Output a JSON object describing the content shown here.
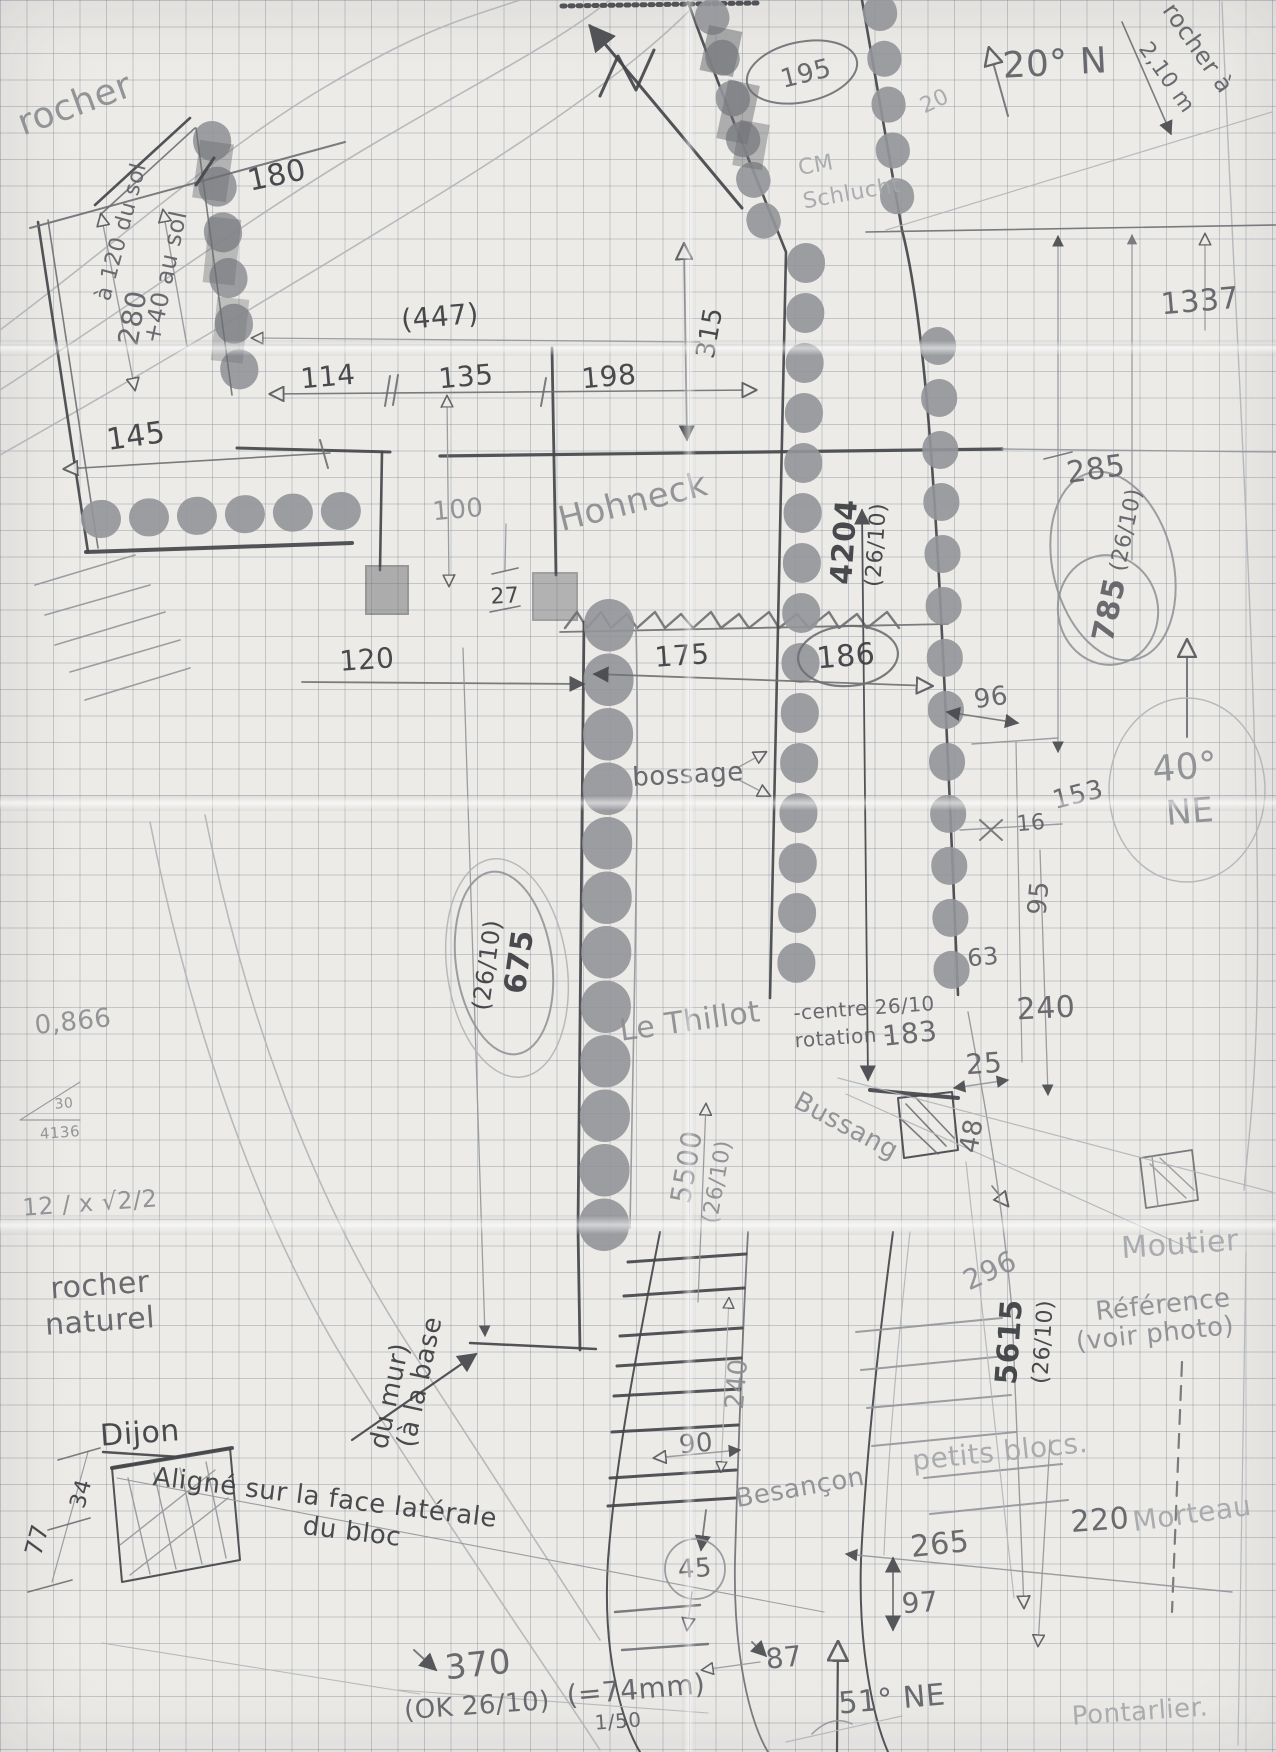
{
  "diagram": {
    "paper": {
      "background": "#ecebe7",
      "grid_color": "rgba(125,135,150,.38)",
      "grid_size_px": 26.5,
      "pencil_dark": "#46474b",
      "pencil_mid": "#6e6f73",
      "pencil_light": "#94959a",
      "pencil_xlight": "#b3b4b8"
    },
    "labels": [
      {
        "id": "rocher-top-left",
        "text": "rocher",
        "x": 75,
        "y": 105,
        "rot": -20,
        "size": 36,
        "tone": "light",
        "bold": false
      },
      {
        "id": "dim-180",
        "text": "180",
        "x": 277,
        "y": 176,
        "rot": -12,
        "size": 30,
        "tone": "dark",
        "bold": false
      },
      {
        "id": "note-a-120-du-sol",
        "text": "à 120 du sol",
        "x": 122,
        "y": 232,
        "rot": -75,
        "size": 22,
        "tone": "mid",
        "bold": false
      },
      {
        "id": "dim-280",
        "text": "280",
        "x": 133,
        "y": 318,
        "rot": -80,
        "size": 28,
        "tone": "mid",
        "bold": false
      },
      {
        "id": "note-plus-40-au-sol",
        "text": "+40 au sol",
        "x": 165,
        "y": 277,
        "rot": -78,
        "size": 24,
        "tone": "mid",
        "bold": false
      },
      {
        "id": "dim-145",
        "text": "145",
        "x": 136,
        "y": 437,
        "rot": -8,
        "size": 30,
        "tone": "dark",
        "bold": false
      },
      {
        "id": "dim-447",
        "text": "(447)",
        "x": 440,
        "y": 317,
        "rot": -5,
        "size": 28,
        "tone": "dark",
        "bold": false
      },
      {
        "id": "dim-114",
        "text": "114",
        "x": 328,
        "y": 377,
        "rot": -5,
        "size": 28,
        "tone": "dark",
        "bold": false
      },
      {
        "id": "dim-135",
        "text": "135",
        "x": 466,
        "y": 377,
        "rot": -5,
        "size": 28,
        "tone": "dark",
        "bold": false
      },
      {
        "id": "dim-198",
        "text": "198",
        "x": 609,
        "y": 377,
        "rot": -5,
        "size": 28,
        "tone": "dark",
        "bold": false
      },
      {
        "id": "dim-315",
        "text": "315",
        "x": 710,
        "y": 333,
        "rot": -80,
        "size": 26,
        "tone": "dark",
        "bold": false
      },
      {
        "id": "dim-195",
        "text": "195",
        "x": 806,
        "y": 74,
        "rot": -14,
        "size": 26,
        "tone": "mid",
        "bold": false
      },
      {
        "id": "note-cm",
        "text": "CM",
        "x": 816,
        "y": 166,
        "rot": -10,
        "size": 22,
        "tone": "xlight",
        "bold": false
      },
      {
        "id": "note-schlucht",
        "text": "Schlucht",
        "x": 852,
        "y": 194,
        "rot": -10,
        "size": 22,
        "tone": "xlight",
        "bold": false
      },
      {
        "id": "dim-20-faint",
        "text": "20",
        "x": 935,
        "y": 102,
        "rot": -25,
        "size": 22,
        "tone": "xlight",
        "bold": false
      },
      {
        "id": "angle-20-n",
        "text": "20° N",
        "x": 1055,
        "y": 64,
        "rot": -3,
        "size": 36,
        "tone": "mid",
        "bold": false
      },
      {
        "id": "note-rocher-a",
        "text": "rocher à",
        "x": 1198,
        "y": 48,
        "rot": 55,
        "size": 24,
        "tone": "mid",
        "bold": false
      },
      {
        "id": "note-2-10-m",
        "text": "2,10 m",
        "x": 1166,
        "y": 78,
        "rot": 55,
        "size": 22,
        "tone": "mid",
        "bold": false
      },
      {
        "id": "dim-1337",
        "text": "1337",
        "x": 1200,
        "y": 302,
        "rot": -5,
        "size": 30,
        "tone": "mid",
        "bold": false
      },
      {
        "id": "dim-100",
        "text": "100",
        "x": 458,
        "y": 510,
        "rot": -5,
        "size": 26,
        "tone": "light",
        "bold": false
      },
      {
        "id": "place-hohneck",
        "text": "Hohneck",
        "x": 633,
        "y": 502,
        "rot": -14,
        "size": 34,
        "tone": "light",
        "bold": false
      },
      {
        "id": "dim-4204",
        "text": "4204",
        "x": 845,
        "y": 542,
        "rot": -86,
        "size": 30,
        "tone": "dark",
        "bold": true
      },
      {
        "id": "dim-4204-date",
        "text": "(26/10)",
        "x": 877,
        "y": 545,
        "rot": -86,
        "size": 22,
        "tone": "dark",
        "bold": false
      },
      {
        "id": "dim-285",
        "text": "285",
        "x": 1096,
        "y": 470,
        "rot": -8,
        "size": 30,
        "tone": "mid",
        "bold": false
      },
      {
        "id": "dim-785",
        "text": "785",
        "x": 1110,
        "y": 610,
        "rot": -78,
        "size": 30,
        "tone": "mid",
        "bold": true
      },
      {
        "id": "dim-785-date",
        "text": "(26/10)",
        "x": 1127,
        "y": 530,
        "rot": -78,
        "size": 22,
        "tone": "mid",
        "bold": false
      },
      {
        "id": "dim-27",
        "text": "27",
        "x": 505,
        "y": 597,
        "rot": -3,
        "size": 22,
        "tone": "dark",
        "bold": false
      },
      {
        "id": "dim-186",
        "text": "186",
        "x": 846,
        "y": 657,
        "rot": -5,
        "size": 30,
        "tone": "dark",
        "bold": false
      },
      {
        "id": "dim-120",
        "text": "120",
        "x": 367,
        "y": 660,
        "rot": -4,
        "size": 28,
        "tone": "dark",
        "bold": false
      },
      {
        "id": "dim-175",
        "text": "175",
        "x": 682,
        "y": 656,
        "rot": -4,
        "size": 28,
        "tone": "dark",
        "bold": false
      },
      {
        "id": "dim-96",
        "text": "96",
        "x": 991,
        "y": 698,
        "rot": -8,
        "size": 26,
        "tone": "mid",
        "bold": false
      },
      {
        "id": "angle-40",
        "text": "40°",
        "x": 1185,
        "y": 768,
        "rot": -5,
        "size": 36,
        "tone": "light",
        "bold": false
      },
      {
        "id": "angle-ne",
        "text": "NE",
        "x": 1190,
        "y": 812,
        "rot": -5,
        "size": 34,
        "tone": "light",
        "bold": false
      },
      {
        "id": "dim-153",
        "text": "153",
        "x": 1078,
        "y": 795,
        "rot": -14,
        "size": 26,
        "tone": "mid",
        "bold": false
      },
      {
        "id": "dim-16",
        "text": "16",
        "x": 1031,
        "y": 824,
        "rot": -5,
        "size": 22,
        "tone": "mid",
        "bold": false
      },
      {
        "id": "note-bossage",
        "text": "bossage",
        "x": 688,
        "y": 775,
        "rot": -3,
        "size": 26,
        "tone": "mid",
        "bold": false
      },
      {
        "id": "dim-95",
        "text": "95",
        "x": 1039,
        "y": 898,
        "rot": -85,
        "size": 26,
        "tone": "mid",
        "bold": false
      },
      {
        "id": "dim-63",
        "text": "63",
        "x": 983,
        "y": 957,
        "rot": -5,
        "size": 24,
        "tone": "mid",
        "bold": false
      },
      {
        "id": "dim-240",
        "text": "240",
        "x": 1046,
        "y": 1009,
        "rot": -3,
        "size": 30,
        "tone": "mid",
        "bold": false
      },
      {
        "id": "dim-675",
        "text": "675",
        "x": 520,
        "y": 962,
        "rot": -82,
        "size": 30,
        "tone": "dark",
        "bold": true
      },
      {
        "id": "dim-675-date",
        "text": "(26/10)",
        "x": 487,
        "y": 965,
        "rot": -82,
        "size": 24,
        "tone": "dark",
        "bold": false
      },
      {
        "id": "place-le-thillot",
        "text": "Le Thillot",
        "x": 690,
        "y": 1022,
        "rot": -8,
        "size": 30,
        "tone": "light",
        "bold": false
      },
      {
        "id": "note-centre-2610",
        "text": "-centre 26/10",
        "x": 864,
        "y": 1008,
        "rot": -4,
        "size": 20,
        "tone": "mid",
        "bold": false
      },
      {
        "id": "note-rotation",
        "text": "rotation -",
        "x": 843,
        "y": 1037,
        "rot": -4,
        "size": 20,
        "tone": "mid",
        "bold": false
      },
      {
        "id": "dim-183",
        "text": "183",
        "x": 910,
        "y": 1034,
        "rot": -6,
        "size": 28,
        "tone": "mid",
        "bold": false
      },
      {
        "id": "dim-25",
        "text": "25",
        "x": 984,
        "y": 1064,
        "rot": -4,
        "size": 28,
        "tone": "mid",
        "bold": false
      },
      {
        "id": "place-bussang",
        "text": "Bussang",
        "x": 846,
        "y": 1126,
        "rot": 28,
        "size": 26,
        "tone": "light",
        "bold": false
      },
      {
        "id": "dim-48",
        "text": "48",
        "x": 972,
        "y": 1136,
        "rot": -80,
        "size": 26,
        "tone": "mid",
        "bold": false
      },
      {
        "id": "num-0-866",
        "text": "0,866",
        "x": 73,
        "y": 1022,
        "rot": -6,
        "size": 26,
        "tone": "light",
        "bold": false
      },
      {
        "id": "num-30",
        "text": "30",
        "x": 64,
        "y": 1104,
        "rot": -5,
        "size": 14,
        "tone": "light",
        "bold": false
      },
      {
        "id": "num-4136",
        "text": "4136",
        "x": 60,
        "y": 1133,
        "rot": -4,
        "size": 15,
        "tone": "light",
        "bold": false
      },
      {
        "id": "formula-sqrt",
        "text": "12 / x √2/2",
        "x": 90,
        "y": 1203,
        "rot": -4,
        "size": 24,
        "tone": "light",
        "bold": false
      },
      {
        "id": "note-rocher-naturel-1",
        "text": "rocher",
        "x": 100,
        "y": 1286,
        "rot": -4,
        "size": 30,
        "tone": "mid",
        "bold": false
      },
      {
        "id": "note-rocher-naturel-2",
        "text": "naturel",
        "x": 100,
        "y": 1322,
        "rot": -4,
        "size": 30,
        "tone": "mid",
        "bold": false
      },
      {
        "id": "dim-5500",
        "text": "5500",
        "x": 687,
        "y": 1167,
        "rot": -80,
        "size": 28,
        "tone": "light",
        "bold": false
      },
      {
        "id": "dim-5500-date",
        "text": "(26/10)",
        "x": 718,
        "y": 1182,
        "rot": -80,
        "size": 22,
        "tone": "light",
        "bold": false
      },
      {
        "id": "dim-296",
        "text": "296",
        "x": 990,
        "y": 1271,
        "rot": -25,
        "size": 28,
        "tone": "light",
        "bold": false
      },
      {
        "id": "place-moutier",
        "text": "Moutier",
        "x": 1180,
        "y": 1245,
        "rot": -4,
        "size": 30,
        "tone": "xlight",
        "bold": false
      },
      {
        "id": "dim-5615",
        "text": "5615",
        "x": 1010,
        "y": 1342,
        "rot": -86,
        "size": 30,
        "tone": "dark",
        "bold": true
      },
      {
        "id": "dim-5615-date",
        "text": "(26/10)",
        "x": 1044,
        "y": 1342,
        "rot": -86,
        "size": 22,
        "tone": "dark",
        "bold": false
      },
      {
        "id": "note-reference",
        "text": "Référence",
        "x": 1163,
        "y": 1305,
        "rot": -6,
        "size": 26,
        "tone": "light",
        "bold": false
      },
      {
        "id": "note-voir-photo",
        "text": "(voir photo)",
        "x": 1155,
        "y": 1334,
        "rot": -6,
        "size": 26,
        "tone": "light",
        "bold": false
      },
      {
        "id": "note-a-la-base",
        "text": "(à la base",
        "x": 420,
        "y": 1382,
        "rot": -78,
        "size": 26,
        "tone": "dark",
        "bold": false
      },
      {
        "id": "note-du-mur",
        "text": "du mur)",
        "x": 390,
        "y": 1396,
        "rot": -78,
        "size": 26,
        "tone": "dark",
        "bold": false
      },
      {
        "id": "place-dijon",
        "text": "Dijon",
        "x": 140,
        "y": 1434,
        "rot": -4,
        "size": 30,
        "tone": "dark",
        "bold": false
      },
      {
        "id": "note-aligne-1",
        "text": "Aligné sur la face latérale",
        "x": 325,
        "y": 1498,
        "rot": 7,
        "size": 26,
        "tone": "dark",
        "bold": false
      },
      {
        "id": "note-aligne-2",
        "text": "du bloc",
        "x": 352,
        "y": 1532,
        "rot": 7,
        "size": 26,
        "tone": "dark",
        "bold": false
      },
      {
        "id": "dim-34",
        "text": "34",
        "x": 82,
        "y": 1494,
        "rot": -75,
        "size": 22,
        "tone": "dark",
        "bold": false
      },
      {
        "id": "dim-77",
        "text": "77",
        "x": 37,
        "y": 1540,
        "rot": -75,
        "size": 24,
        "tone": "dark",
        "bold": false
      },
      {
        "id": "dim-240-rot",
        "text": "240",
        "x": 737,
        "y": 1384,
        "rot": -85,
        "size": 26,
        "tone": "light",
        "bold": false
      },
      {
        "id": "dim-90",
        "text": "90",
        "x": 696,
        "y": 1444,
        "rot": -5,
        "size": 26,
        "tone": "mid",
        "bold": false
      },
      {
        "id": "place-besancon",
        "text": "Besançon",
        "x": 800,
        "y": 1488,
        "rot": -10,
        "size": 26,
        "tone": "light",
        "bold": false
      },
      {
        "id": "note-petits-blocs",
        "text": "petits blocs.",
        "x": 1000,
        "y": 1452,
        "rot": -6,
        "size": 28,
        "tone": "xlight",
        "bold": false
      },
      {
        "id": "dim-265",
        "text": "265",
        "x": 940,
        "y": 1545,
        "rot": -6,
        "size": 30,
        "tone": "mid",
        "bold": false
      },
      {
        "id": "dim-220",
        "text": "220",
        "x": 1100,
        "y": 1521,
        "rot": -4,
        "size": 30,
        "tone": "mid",
        "bold": false
      },
      {
        "id": "place-morteau",
        "text": "Morteau",
        "x": 1192,
        "y": 1514,
        "rot": -8,
        "size": 28,
        "tone": "xlight",
        "bold": false
      },
      {
        "id": "dim-97",
        "text": "97",
        "x": 920,
        "y": 1603,
        "rot": -4,
        "size": 28,
        "tone": "mid",
        "bold": false
      },
      {
        "id": "dim-45",
        "text": "45",
        "x": 695,
        "y": 1569,
        "rot": -4,
        "size": 26,
        "tone": "mid",
        "bold": false
      },
      {
        "id": "dim-87",
        "text": "87",
        "x": 784,
        "y": 1658,
        "rot": -6,
        "size": 28,
        "tone": "mid",
        "bold": false
      },
      {
        "id": "dim-370",
        "text": "370",
        "x": 478,
        "y": 1665,
        "rot": -6,
        "size": 34,
        "tone": "mid",
        "bold": false
      },
      {
        "id": "note-ok-2610",
        "text": "(OK 26/10)",
        "x": 477,
        "y": 1706,
        "rot": -4,
        "size": 26,
        "tone": "mid",
        "bold": false
      },
      {
        "id": "note-eq-74mm",
        "text": "(=74mm)",
        "x": 636,
        "y": 1690,
        "rot": -5,
        "size": 28,
        "tone": "mid",
        "bold": false
      },
      {
        "id": "scale-1-50",
        "text": "1/50",
        "x": 618,
        "y": 1721,
        "rot": -4,
        "size": 20,
        "tone": "mid",
        "bold": false
      },
      {
        "id": "angle-51-ne",
        "text": "51° NE",
        "x": 892,
        "y": 1700,
        "rot": -5,
        "size": 30,
        "tone": "mid",
        "bold": false
      },
      {
        "id": "place-pontarlier",
        "text": "Pontarlier.",
        "x": 1140,
        "y": 1712,
        "rot": -4,
        "size": 26,
        "tone": "xlight",
        "bold": false
      }
    ]
  }
}
